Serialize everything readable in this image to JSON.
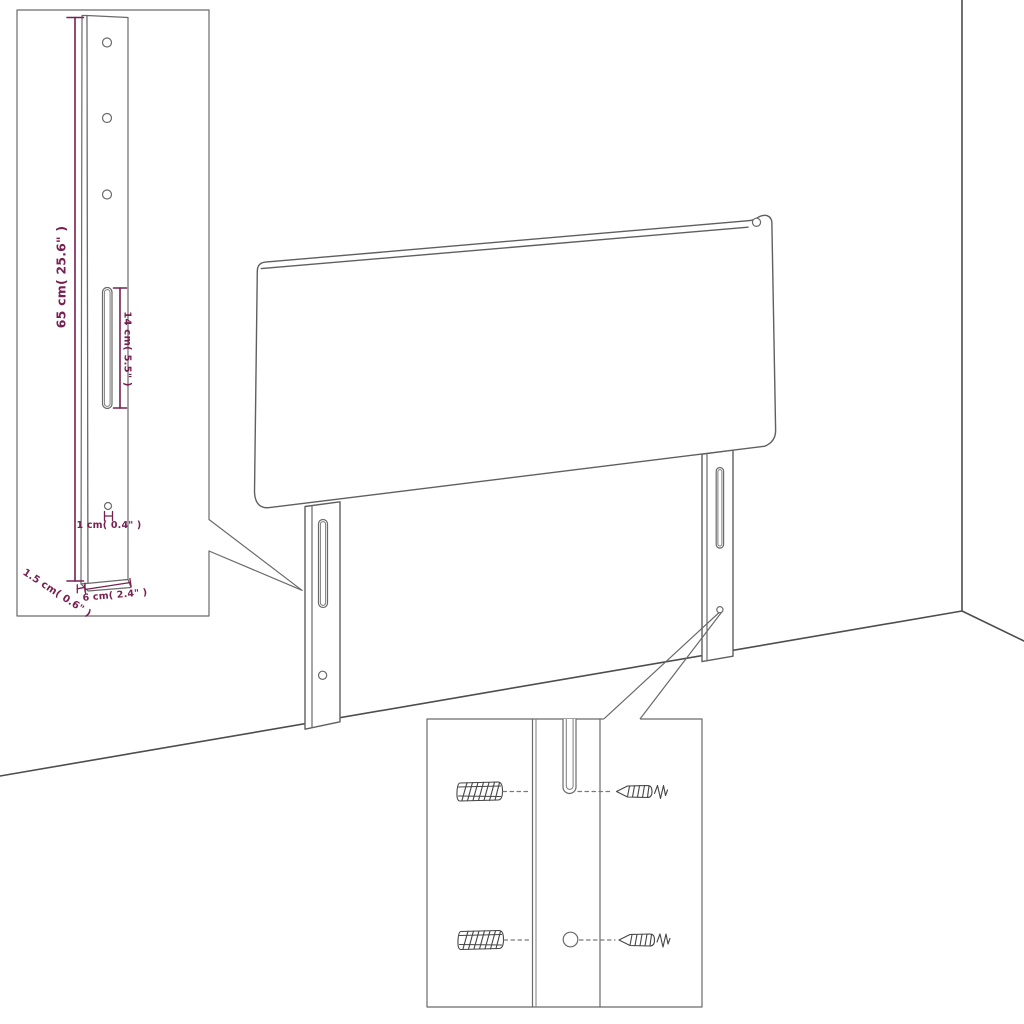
{
  "colors": {
    "background": "#ffffff",
    "outline_gray": "#5f5f5f",
    "room_line_gray": "#4d4d4d",
    "dimension_purple": "#772052",
    "hardware_sketch_gray": "#454545"
  },
  "dimension_labels": {
    "leg_height": "65 cm( 25.6\" )",
    "slot_length": "14 cm( 5.5\" )",
    "hole_diameter": "1 cm( 0.4\" )",
    "leg_depth": "1.5 cm( 0.6\" )",
    "leg_width": "6 cm( 2.4\" )"
  }
}
